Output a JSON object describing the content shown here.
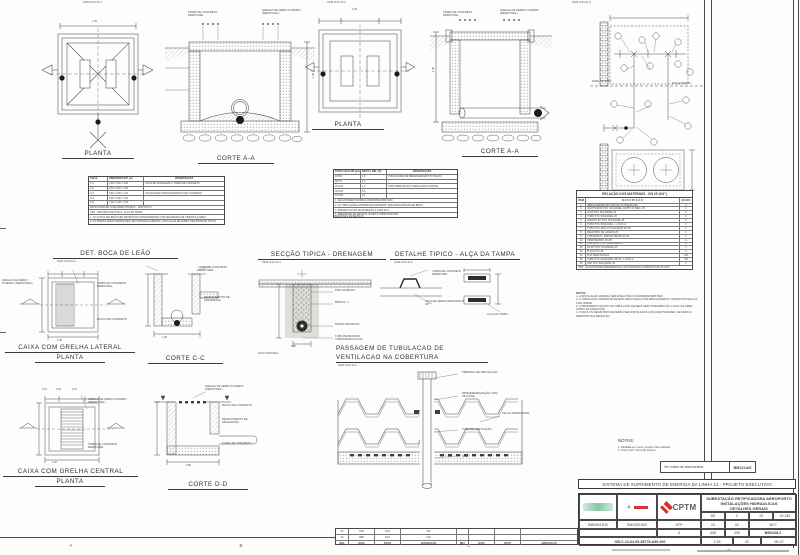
{
  "sheet": {
    "ink": "#3f3f3f",
    "red": "#d92b1f"
  },
  "labels": {
    "sem_escala": "SEM ESCALA",
    "planta": "PLANTA",
    "corte_aa": "CORTE A-A",
    "corte_cc": "CORTE C-C",
    "corte_dd": "CORTE D-D",
    "det_boca": "DET. BOCA DE LEÃO",
    "seccao": "SECÇÃO TIPICA - DRENAGEM",
    "detalhe_alca": "DETALHE TIPICO - ALÇA DA TAMPA",
    "passagem1": "PASSAGEM DE TUBULACAO DE",
    "passagem2": "VENTILACAO NA COBERTURA",
    "caixa_lat": "CAIXA COM GRELHA LATERAL",
    "caixa_cen": "CAIXA COM GRELHA CENTRAL"
  },
  "grid": {
    "a": "A",
    "b": "B",
    "c": "C",
    "d": "D"
  },
  "ann": {
    "tampa": "TAMPA DE CONCRETO REMOVIVEL",
    "grelha": "GRELHA DE FERRO FUNDIDO (REMOVIVEL)",
    "bloco": "BLOCO DE CONCRETO",
    "revest": "REVESTIMENTO DE ARGAMASSA",
    "canal": "CANAL DE CONCRETO",
    "brita": "BRITA Nº 3",
    "manta": "MANTA GEOTEXTIL",
    "tubo_perf": "TUBO PERFURADO CORRUGADO DN 100",
    "solo": "SOLO NATURAL",
    "piso": "PISO ACABADO",
    "terminal": "TERMINAL DE VENTILAÇÃO",
    "imperm": "IMPERMEABILIZAÇÃO COM SILICONE",
    "telha": "TELHA TRAPEZOIDAL",
    "tubo_vent": "TUBO DE VENTILAÇÃO",
    "laje": "LAJE",
    "alca_ferro": "ALÇA DE FERRO REDONDO Ø 3/8\"",
    "alca_tampa": "ALÇA DA TAMPA",
    "nivel_piso": "NÍVEL DO PISO",
    "rua": "RUA EXTERNA"
  },
  "dims": {
    "w105": "1,05",
    "w015": "0,15",
    "w060": "0,60",
    "h146": "1,46",
    "w025": "0,25",
    "w080": "0,80"
  },
  "spec1": {
    "h": [
      "CAIXA",
      "DIMENSÕES INT. (m)",
      "OBSERVAÇÕES"
    ],
    "rows": [
      [
        "C-1",
        "0,60 x 0,60 x 0,80",
        "CAIXA DE PASSAGEM C/ TAMPA DE CONCRETO"
      ],
      [
        "C-2",
        "0,60 x 0,60 x 1,00",
        ""
      ],
      [
        "C-3",
        "0,80 x 0,80 x 1,00",
        "CAIXAS EXECUTADAS EM BLOCO DE CONCRETO"
      ],
      [
        "C-4",
        "0,80 x 0,80 x 1,20",
        ""
      ],
      [
        "C-5",
        "1,00 x 1,00 x 1,50",
        ""
      ]
    ],
    "m1": "PROFUNDIDADE CONFORME PROJETO - VER NOTA 2",
    "m2": "OBS.: VER DETALHE TIPICO - ALÇA DA TAMPA",
    "n1": "1- AS CAIXAS DEVERÃO SER REVESTIDAS INTERNAMENTE COM ARGAMASSA DE CIMENTO E AREIA",
    "n2": "2- AS TAMPAS SERÃO REMOVIVEIS, EM CONCRETO ARMADO, COM ALÇAS DE FERRO (VER DETALHE TIPICO)"
  },
  "spec2": {
    "h": [
      "TUBULAÇÃO DN (mm)",
      "DECLIV. MIN. (%)",
      "OBSERVAÇÕES"
    ],
    "rows": [
      [
        "DN 50",
        "2,0",
        "TUBULAÇÕES DE DRENAGEM EM PVC RIGIDO"
      ],
      [
        "DN 75",
        "1,5",
        ""
      ],
      [
        "DN 100",
        "1,0",
        "TUBO PERFURADO CORRUGADO FLEXIVEL"
      ],
      [
        "DN 150",
        "0,5",
        ""
      ],
      [
        "DN 200",
        "0,4",
        ""
      ]
    ],
    "n1": "1- DECLIVIDADES MINIMAS CONFORME NBR 8160",
    "n2": "2- AS TUBULAÇÕES ENTERRADAS DEVERÃO SER ENVELOPADAS EM BRITA",
    "n3": "3- PREVER CAIXAS DE INSPEÇÃO A CADA 25 m",
    "n4": "4- DIMENSÕES EM METROS, EXCETO ONDE INDICADO",
    "foot": "DIMENSÕES EM METROS"
  },
  "materials": {
    "title": "RELAÇÃO DOS MATERIAIS - DN 25 (3/4\")",
    "h": [
      "ITEM",
      "D E S C R I Ç Ã O",
      "QUANT."
    ],
    "rows": [
      [
        "1",
        "ABRAÇADEIRA DE FIXAÇÃO C/ PARAFUSO",
        "4"
      ],
      [
        "2",
        "ADAPTADOR PVC SOLDAVEL CURTO P/ REG. 25",
        "2"
      ],
      [
        "3",
        "LUVA PVC SOLDAVEL 25",
        "2"
      ],
      [
        "4",
        "TUBO PVC SOLDAVEL 25",
        "2"
      ],
      [
        "5",
        "JOELHO 90º PVC SOLDAVEL 25",
        "6"
      ],
      [
        "6",
        "TUBO PVC SOLDAVEL - L=2,00 m",
        "1"
      ],
      [
        "7",
        "TUBO PVC AZUL P/ CAVALETE DN 25",
        "1"
      ],
      [
        "8",
        "REGISTRO DE GAVETA 25",
        "1"
      ],
      [
        "9",
        "TORNEIRA P/ JARDIM METALICA 25",
        "1"
      ],
      [
        "10",
        "HIDROMETRO DN 25",
        "1"
      ],
      [
        "11",
        "CURVA 90º PVC SOLDAVEL 25",
        "2"
      ],
      [
        "12",
        "TE 90º PVC SOLDAVEL 25",
        "1"
      ],
      [
        "13",
        "PLUG PVC 25",
        "1"
      ],
      [
        "14",
        "FITA VEDA ROSCA",
        "1 RL"
      ],
      [
        "15",
        "TUBO PVC SOLDAVEL DN 25 - L=3,00 m",
        "VB"
      ],
      [
        "16",
        "CAP PVC SOLDAVEL 25",
        "1"
      ]
    ],
    "obs": "OBS.: QUANTIDADES REFERENTES A UM CAVALETE COMPLETO DN 25 (3/4\")"
  },
  "mat_notes": {
    "t": "NOTAS:",
    "n1": "1- A INSTALAÇÃO DEVERÁ SER EXECUTADA CONFORME NBR 5626",
    "n2": "2- A TUBULAÇÃO APARENTE DEVERÁ SER FIXADA COM ABRAÇADEIRAS, SENDO PINTADA NA COR VERDE",
    "n3": "3- COMPRIMENTO EXATO DA TUBULAÇÃO DEVERÁ SER CONFERIDO NO LOCAL DA OBRA ANTES DA EXECUÇÃO",
    "n4": "4- TODOS OS REGISTROS DEVERÃO SER INSTALADOS COM ADAPTADORES, DE MODO A PERMITIR SUA REMOÇÃO"
  },
  "notas": {
    "t": "NOTAS:",
    "n1": "1- Medidas em metro, exceto onde indicado",
    "n2": "2- Nível 0,00 = Nível do terreno"
  },
  "indice": {
    "label": "Ver índice de documentos",
    "code": "BB1214/0"
  },
  "tb": {
    "banner": "SISTEMA DE SUPRIMENTO DE ENERGIA DA LINHA 13 - PROJETO EXECUTIVO",
    "t1": "SUBESTAÇÃO RETIFICADORA AEROPORTO",
    "t2": "INSTALAÇÕES HIDRAULICAS",
    "t3": "DETALHES GERAIS",
    "cptm": "CPTM",
    "de": "DE",
    "c": "C",
    "n13": "13",
    "seq": "24-240",
    "c1": "8365/3021130",
    "c2": "8343/3301100",
    "gfp": "GFP",
    "f24": "24",
    "f02": "02",
    "f3677": "3677",
    "f6": "6",
    "fa": "A08",
    "f005": "005",
    "fcode": "BB0438-2",
    "doc": "OB-C-13-04-05-58778-A99-000",
    "esc": "1:25",
    "rev": "02",
    "fl": "05-07"
  },
  "revs": {
    "h": [
      "REV.",
      "DATA",
      "VISTO",
      "APROVAÇÃO"
    ],
    "r1": [
      "02",
      "GFP",
      "FGS",
      "GW"
    ],
    "r2": [
      "00",
      "ABR",
      "FGS",
      "GW"
    ]
  }
}
